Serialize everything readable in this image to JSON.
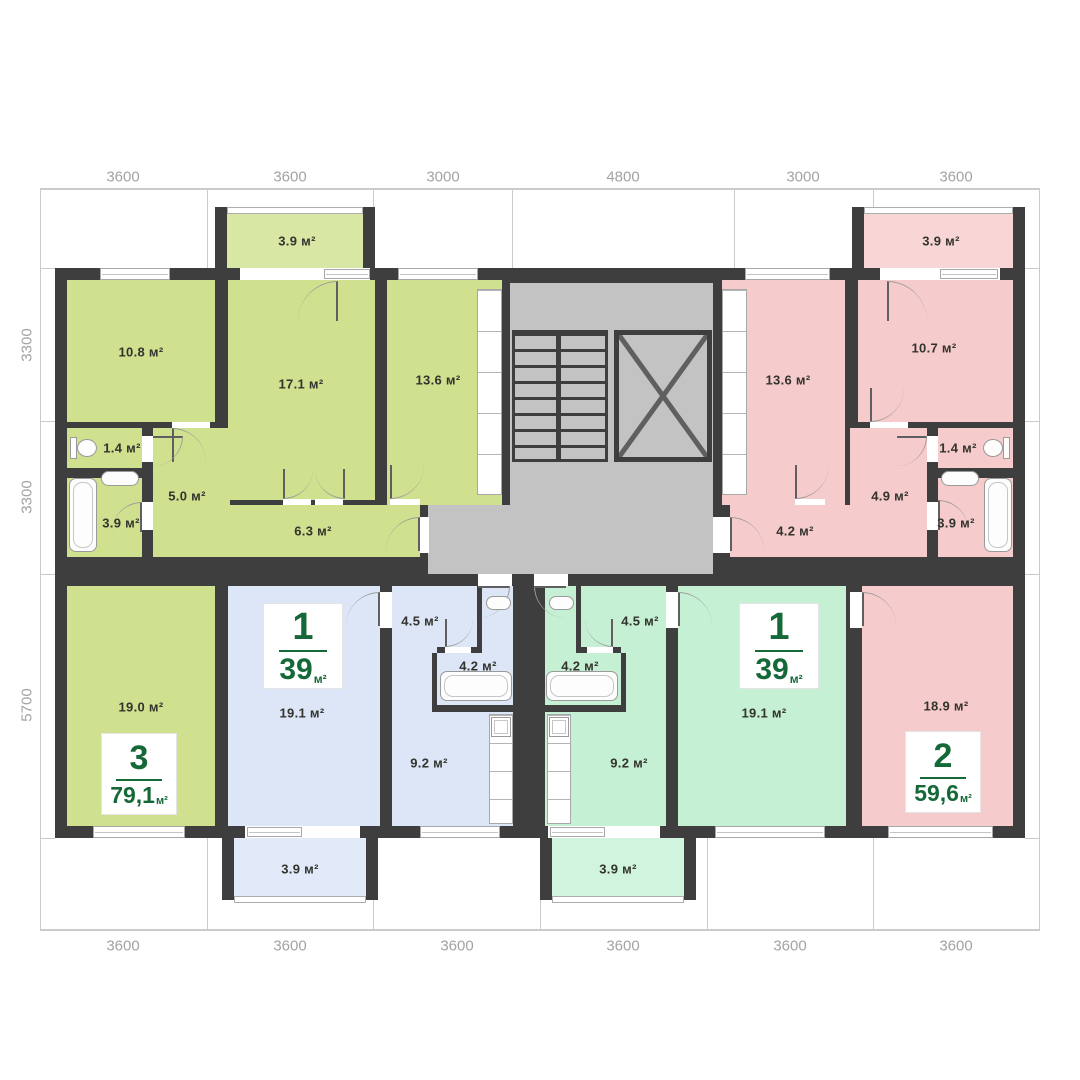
{
  "plan_title": "apartment-floor-plan",
  "dimensions": {
    "top": [
      "3600",
      "3600",
      "3000",
      "4800",
      "3000",
      "3600"
    ],
    "bottom": [
      "3600",
      "3600",
      "3600",
      "3600",
      "3600",
      "3600"
    ],
    "left": [
      "3300",
      "3300",
      "5700"
    ]
  },
  "apartments": {
    "apt3": {
      "color": "#cfe08f",
      "balcony_color": "#d9e7a4",
      "badge_number": "3",
      "badge_area": "79,1",
      "badge_unit": "м²",
      "rooms": {
        "balcony": "3.9 м²",
        "bedroom": "10.8 м²",
        "living": "17.1 м²",
        "bedroom2": "13.6 м²",
        "wc": "1.4 м²",
        "hall": "5.0 м²",
        "bath": "3.9 м²",
        "corridor": "6.3 м²",
        "room19": "19.0 м²"
      }
    },
    "apt1_left": {
      "color": "#dce6f7",
      "balcony_color": "#e2eafa",
      "badge_number": "1",
      "badge_area": "39",
      "badge_unit": "м²",
      "rooms": {
        "hall": "4.5 м²",
        "bath": "4.2 м²",
        "kitchen": "9.2 м²",
        "living": "19.1 м²",
        "balcony": "3.9 м²"
      }
    },
    "apt1_right": {
      "color": "#c5f0d3",
      "balcony_color": "#d0f4dd",
      "badge_number": "1",
      "badge_area": "39",
      "badge_unit": "м²",
      "rooms": {
        "hall": "4.5 м²",
        "bath": "4.2 м²",
        "kitchen": "9.2 м²",
        "living": "19.1 м²",
        "balcony": "3.9 м²"
      }
    },
    "apt2": {
      "color": "#f6cbcb",
      "balcony_color": "#f8d6d6",
      "badge_number": "2",
      "badge_area": "59,6",
      "badge_unit": "м²",
      "rooms": {
        "balcony": "3.9 м²",
        "bedroom": "13.6 м²",
        "bedroom2": "10.7 м²",
        "wc": "1.4 м²",
        "hall": "4.9 м²",
        "corridor": "4.2 м²",
        "bath": "3.9 м²",
        "living": "18.9 м²"
      }
    }
  },
  "colors": {
    "walls": "#3e3e3e",
    "stairwell": "#c3c3c3",
    "frame": "#cbcbcb",
    "dimension_text": "#a3a3a3",
    "room_text": "#33332e",
    "badge_green": "#156939"
  }
}
